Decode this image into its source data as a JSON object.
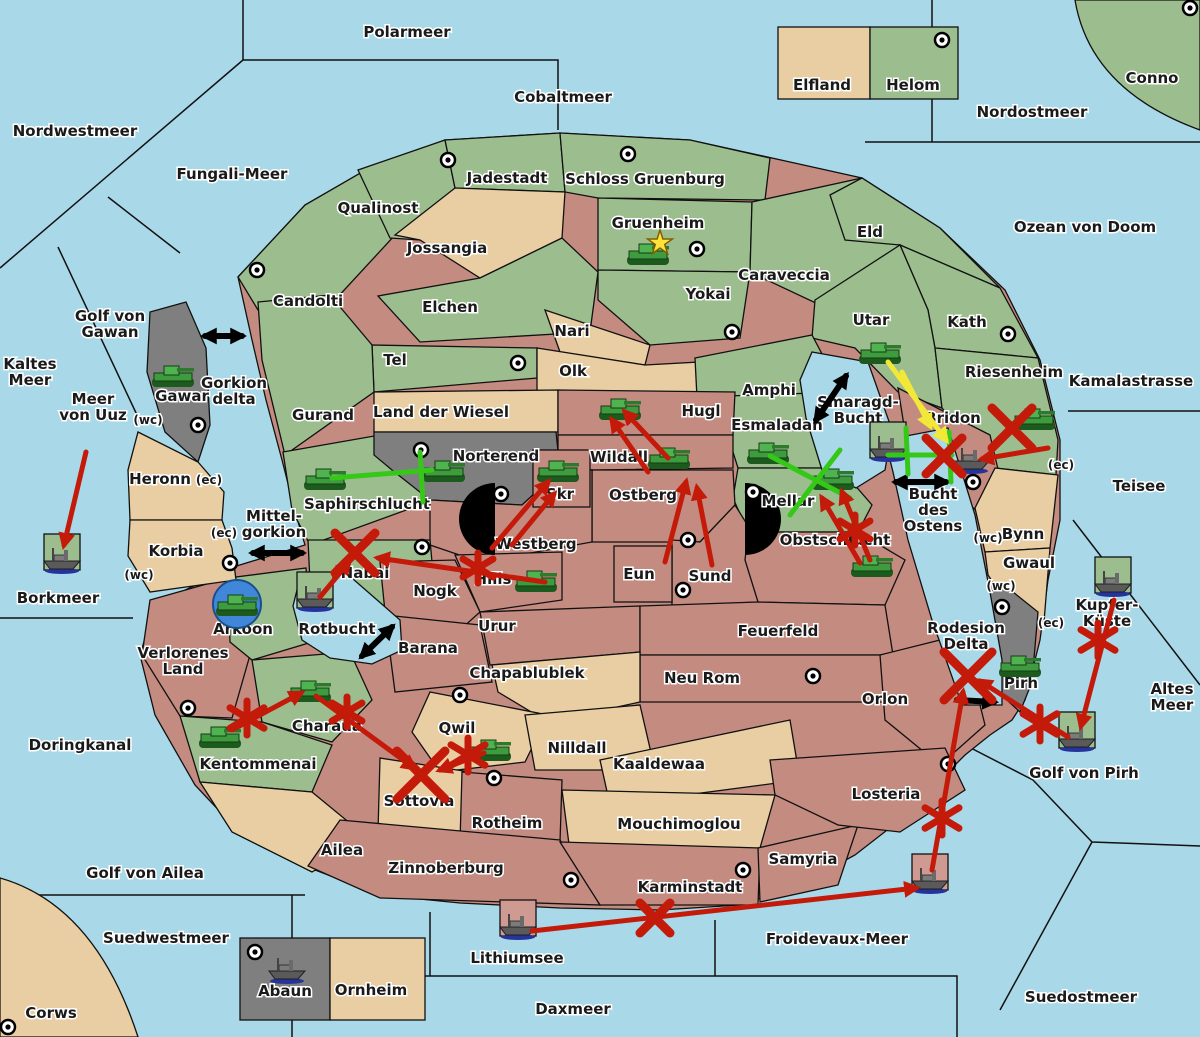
{
  "map": {
    "colors": {
      "sea": "#A9D9E8",
      "land_green": "#9CBE8F",
      "land_tan": "#E8CEA2",
      "land_red": "#C48B81",
      "land_gray": "#7F7F7F",
      "order_red": "#C41A0A",
      "order_green": "#35C818",
      "order_yellow": "#F2E838",
      "order_black": "#000000"
    },
    "labels": [
      {
        "text": "Nordwestmeer",
        "x": 75,
        "y": 131,
        "kind": "sea"
      },
      {
        "text": "Polarmeer",
        "x": 407,
        "y": 32,
        "kind": "sea"
      },
      {
        "text": "Cobaltmeer",
        "x": 563,
        "y": 97,
        "kind": "sea"
      },
      {
        "text": "Nordostmeer",
        "x": 1032,
        "y": 112,
        "kind": "sea"
      },
      {
        "text": "Ozean von Doom",
        "x": 1085,
        "y": 227,
        "kind": "sea"
      },
      {
        "text": "Fungali-Meer",
        "x": 232,
        "y": 174,
        "kind": "sea"
      },
      {
        "text": "Kaltes\nMeer",
        "x": 30,
        "y": 372,
        "kind": "sea"
      },
      {
        "text": "Golf von\nGawan",
        "x": 110,
        "y": 324,
        "kind": "sea"
      },
      {
        "text": "Meer\nvon Uuz",
        "x": 93,
        "y": 407,
        "kind": "sea"
      },
      {
        "text": "Kamalastrasse",
        "x": 1131,
        "y": 381,
        "kind": "sea"
      },
      {
        "text": "Teisee",
        "x": 1139,
        "y": 486,
        "kind": "sea"
      },
      {
        "text": "Borkmeer",
        "x": 58,
        "y": 598,
        "kind": "sea"
      },
      {
        "text": "Doringkanal",
        "x": 80,
        "y": 745,
        "kind": "sea"
      },
      {
        "text": "Golf von Ailea",
        "x": 145,
        "y": 873,
        "kind": "sea"
      },
      {
        "text": "Suedwestmeer",
        "x": 166,
        "y": 938,
        "kind": "sea"
      },
      {
        "text": "Altes\nMeer",
        "x": 1172,
        "y": 697,
        "kind": "sea"
      },
      {
        "text": "Golf von Pirh",
        "x": 1084,
        "y": 773,
        "kind": "sea"
      },
      {
        "text": "Froidevaux-Meer",
        "x": 837,
        "y": 939,
        "kind": "sea"
      },
      {
        "text": "Daxmeer",
        "x": 573,
        "y": 1009,
        "kind": "sea"
      },
      {
        "text": "Suedostmeer",
        "x": 1081,
        "y": 997,
        "kind": "sea"
      },
      {
        "text": "Kupfer-\nKüste",
        "x": 1107,
        "y": 613,
        "kind": "sea"
      },
      {
        "text": "Smaragd-\nBucht",
        "x": 858,
        "y": 410,
        "kind": "sea"
      },
      {
        "text": "Bucht\ndes\nOstens",
        "x": 933,
        "y": 510,
        "kind": "sea"
      },
      {
        "text": "Rodesion\nDelta",
        "x": 966,
        "y": 636,
        "kind": "sea"
      },
      {
        "text": "Mittel-\ngorkion",
        "x": 274,
        "y": 524,
        "kind": "sea"
      },
      {
        "text": "Gorkion\ndelta",
        "x": 234,
        "y": 391,
        "kind": "sea"
      },
      {
        "text": "Rotbucht",
        "x": 337,
        "y": 629,
        "kind": "sea"
      },
      {
        "text": "Lithiumsee",
        "x": 517,
        "y": 958,
        "kind": "sea"
      },
      {
        "text": "Qualinost",
        "x": 378,
        "y": 208,
        "kind": "land"
      },
      {
        "text": "Jadestadt",
        "x": 507,
        "y": 178,
        "kind": "land"
      },
      {
        "text": "Schloss Gruenburg",
        "x": 645,
        "y": 179,
        "kind": "land"
      },
      {
        "text": "Gruenheim",
        "x": 658,
        "y": 223,
        "kind": "land"
      },
      {
        "text": "Caraveccia",
        "x": 784,
        "y": 275,
        "kind": "land"
      },
      {
        "text": "Yokai",
        "x": 708,
        "y": 294,
        "kind": "land"
      },
      {
        "text": "Eld",
        "x": 870,
        "y": 232,
        "kind": "land"
      },
      {
        "text": "Utar",
        "x": 871,
        "y": 320,
        "kind": "land"
      },
      {
        "text": "Kath",
        "x": 967,
        "y": 322,
        "kind": "land"
      },
      {
        "text": "Riesenheim",
        "x": 1014,
        "y": 372,
        "kind": "land"
      },
      {
        "text": "Bridon",
        "x": 953,
        "y": 418,
        "kind": "land"
      },
      {
        "text": "Candolti",
        "x": 308,
        "y": 301,
        "kind": "land"
      },
      {
        "text": "Elchen",
        "x": 450,
        "y": 307,
        "kind": "land"
      },
      {
        "text": "Nari",
        "x": 572,
        "y": 331,
        "kind": "land"
      },
      {
        "text": "Tel",
        "x": 395,
        "y": 360,
        "kind": "land"
      },
      {
        "text": "Olk",
        "x": 573,
        "y": 371,
        "kind": "land"
      },
      {
        "text": "Gurand",
        "x": 323,
        "y": 415,
        "kind": "land"
      },
      {
        "text": "Jossangia",
        "x": 447,
        "y": 248,
        "kind": "land"
      },
      {
        "text": "Land der Wiesel",
        "x": 441,
        "y": 412,
        "kind": "land"
      },
      {
        "text": "Amphi",
        "x": 769,
        "y": 390,
        "kind": "land"
      },
      {
        "text": "Esmaladan",
        "x": 777,
        "y": 425,
        "kind": "land"
      },
      {
        "text": "Mellar",
        "x": 788,
        "y": 501,
        "kind": "land"
      },
      {
        "text": "Norterend",
        "x": 496,
        "y": 456,
        "kind": "land"
      },
      {
        "text": "Wildall",
        "x": 619,
        "y": 457,
        "kind": "land"
      },
      {
        "text": "Skr",
        "x": 560,
        "y": 494,
        "kind": "land"
      },
      {
        "text": "Ostberg",
        "x": 643,
        "y": 495,
        "kind": "land"
      },
      {
        "text": "Westberg",
        "x": 536,
        "y": 544,
        "kind": "land"
      },
      {
        "text": "Hugl",
        "x": 701,
        "y": 411,
        "kind": "land"
      },
      {
        "text": "Saphirschlucht",
        "x": 367,
        "y": 504,
        "kind": "land"
      },
      {
        "text": "Eun",
        "x": 639,
        "y": 574,
        "kind": "land"
      },
      {
        "text": "Sund",
        "x": 710,
        "y": 576,
        "kind": "land"
      },
      {
        "text": "Obstschlucht",
        "x": 835,
        "y": 540,
        "kind": "land"
      },
      {
        "text": "Hills",
        "x": 493,
        "y": 579,
        "kind": "land"
      },
      {
        "text": "Nabai",
        "x": 365,
        "y": 573,
        "kind": "land"
      },
      {
        "text": "Nogk",
        "x": 435,
        "y": 591,
        "kind": "land"
      },
      {
        "text": "Urur",
        "x": 497,
        "y": 626,
        "kind": "land"
      },
      {
        "text": "Barana",
        "x": 428,
        "y": 648,
        "kind": "land"
      },
      {
        "text": "Chapablublek",
        "x": 527,
        "y": 673,
        "kind": "land"
      },
      {
        "text": "Feuerfeld",
        "x": 778,
        "y": 631,
        "kind": "land"
      },
      {
        "text": "Neu Rom",
        "x": 702,
        "y": 678,
        "kind": "land"
      },
      {
        "text": "Orlon",
        "x": 885,
        "y": 699,
        "kind": "land"
      },
      {
        "text": "Qwil",
        "x": 457,
        "y": 728,
        "kind": "land"
      },
      {
        "text": "Nilldall",
        "x": 577,
        "y": 748,
        "kind": "land"
      },
      {
        "text": "Kaaldewaa",
        "x": 659,
        "y": 764,
        "kind": "land"
      },
      {
        "text": "Sottovia",
        "x": 419,
        "y": 801,
        "kind": "land"
      },
      {
        "text": "Rotheim",
        "x": 507,
        "y": 823,
        "kind": "land"
      },
      {
        "text": "Mouchimoglou",
        "x": 679,
        "y": 824,
        "kind": "land"
      },
      {
        "text": "Verlorenes\nLand",
        "x": 183,
        "y": 661,
        "kind": "land"
      },
      {
        "text": "Arkoon",
        "x": 243,
        "y": 629,
        "kind": "land"
      },
      {
        "text": "Charaua",
        "x": 327,
        "y": 726,
        "kind": "land"
      },
      {
        "text": "Kentommenai",
        "x": 258,
        "y": 764,
        "kind": "land"
      },
      {
        "text": "Ailea",
        "x": 342,
        "y": 850,
        "kind": "land"
      },
      {
        "text": "Zinnoberburg",
        "x": 446,
        "y": 868,
        "kind": "land"
      },
      {
        "text": "Karminstadt",
        "x": 690,
        "y": 887,
        "kind": "land"
      },
      {
        "text": "Samyria",
        "x": 803,
        "y": 859,
        "kind": "land"
      },
      {
        "text": "Losteria",
        "x": 886,
        "y": 794,
        "kind": "land"
      },
      {
        "text": "Heronn",
        "x": 160,
        "y": 479,
        "kind": "land"
      },
      {
        "text": "Korbia",
        "x": 176,
        "y": 551,
        "kind": "land"
      },
      {
        "text": "Gawar",
        "x": 182,
        "y": 396,
        "kind": "land"
      },
      {
        "text": "Pirh",
        "x": 1021,
        "y": 683,
        "kind": "land"
      },
      {
        "text": "Bynn",
        "x": 1023,
        "y": 534,
        "kind": "land"
      },
      {
        "text": "Gwaul",
        "x": 1029,
        "y": 563,
        "kind": "land"
      },
      {
        "text": "Abaun",
        "x": 285,
        "y": 991,
        "kind": "land"
      },
      {
        "text": "Ornheim",
        "x": 371,
        "y": 990,
        "kind": "land"
      },
      {
        "text": "Corws",
        "x": 51,
        "y": 1013,
        "kind": "land"
      },
      {
        "text": "Elfland",
        "x": 822,
        "y": 85,
        "kind": "land"
      },
      {
        "text": "Helom",
        "x": 913,
        "y": 85,
        "kind": "land"
      },
      {
        "text": "Conno",
        "x": 1152,
        "y": 78,
        "kind": "land"
      },
      {
        "text": "(wc)",
        "x": 148,
        "y": 419,
        "kind": "tag"
      },
      {
        "text": "(ec)",
        "x": 209,
        "y": 479,
        "kind": "tag"
      },
      {
        "text": "(ec)",
        "x": 224,
        "y": 532,
        "kind": "tag"
      },
      {
        "text": "(wc)",
        "x": 139,
        "y": 574,
        "kind": "tag"
      },
      {
        "text": "(ec)",
        "x": 1061,
        "y": 464,
        "kind": "tag"
      },
      {
        "text": "(wc)",
        "x": 988,
        "y": 537,
        "kind": "tag"
      },
      {
        "text": "(wc)",
        "x": 1001,
        "y": 585,
        "kind": "tag"
      },
      {
        "text": "(ec)",
        "x": 1051,
        "y": 622,
        "kind": "tag"
      }
    ],
    "supply_centers": [
      [
        448,
        160
      ],
      [
        628,
        154
      ],
      [
        697,
        249
      ],
      [
        942,
        40
      ],
      [
        1190,
        8
      ],
      [
        257,
        270
      ],
      [
        518,
        363
      ],
      [
        732,
        332
      ],
      [
        1008,
        334
      ],
      [
        198,
        425
      ],
      [
        421,
        450
      ],
      [
        753,
        492
      ],
      [
        501,
        494
      ],
      [
        688,
        540
      ],
      [
        683,
        590
      ],
      [
        973,
        482
      ],
      [
        230,
        563
      ],
      [
        422,
        547
      ],
      [
        460,
        695
      ],
      [
        494,
        778
      ],
      [
        571,
        880
      ],
      [
        743,
        870
      ],
      [
        948,
        764
      ],
      [
        813,
        676
      ],
      [
        1002,
        607
      ],
      [
        255,
        952
      ],
      [
        8,
        1027
      ],
      [
        188,
        708
      ]
    ],
    "capital_star": {
      "x": 660,
      "y": 243
    },
    "arkoon_circle": {
      "x": 237,
      "y": 604,
      "r": 24
    },
    "units": {
      "tanks": [
        {
          "x": 648,
          "y": 253,
          "territory": "Gruenheim"
        },
        {
          "x": 173,
          "y": 375,
          "territory": "Gawar"
        },
        {
          "x": 880,
          "y": 352,
          "territory": "Utar"
        },
        {
          "x": 325,
          "y": 478,
          "territory": "Saphirschlucht"
        },
        {
          "x": 444,
          "y": 470,
          "territory": "Norterend"
        },
        {
          "x": 558,
          "y": 470,
          "territory": "Skr"
        },
        {
          "x": 620,
          "y": 408,
          "territory": "Hugl"
        },
        {
          "x": 669,
          "y": 457,
          "territory": "Wildall"
        },
        {
          "x": 768,
          "y": 452,
          "territory": "Esmaladan"
        },
        {
          "x": 833,
          "y": 478,
          "territory": "Mellar"
        },
        {
          "x": 1034,
          "y": 418,
          "territory": "Riesenheim"
        },
        {
          "x": 536,
          "y": 580,
          "territory": "Hills"
        },
        {
          "x": 237,
          "y": 604,
          "territory": "Arkoon"
        },
        {
          "x": 310,
          "y": 690,
          "territory": "Charaua"
        },
        {
          "x": 220,
          "y": 736,
          "territory": "Kentommenai"
        },
        {
          "x": 490,
          "y": 749,
          "territory": "Qwil"
        },
        {
          "x": 872,
          "y": 565,
          "territory": "Obstschlucht"
        },
        {
          "x": 1020,
          "y": 665,
          "territory": "Pirh"
        }
      ],
      "ships": [
        {
          "x": 62,
          "y": 562,
          "box": "green",
          "territory": "Borkmeer"
        },
        {
          "x": 888,
          "y": 450,
          "box": "green",
          "territory": "Smaragd-Bucht"
        },
        {
          "x": 315,
          "y": 600,
          "box": "green",
          "territory": "Rotbucht"
        },
        {
          "x": 1113,
          "y": 585,
          "box": "green",
          "territory": "Kupfer-Küste"
        },
        {
          "x": 1077,
          "y": 740,
          "box": "green",
          "territory": "Golf von Pirh"
        },
        {
          "x": 518,
          "y": 928,
          "box": "red",
          "territory": "Lithiumsee"
        },
        {
          "x": 930,
          "y": 882,
          "box": "red",
          "territory": "Froidevaux-Meer"
        },
        {
          "x": 971,
          "y": 462,
          "box": "none",
          "territory": "Bridon"
        },
        {
          "x": 287,
          "y": 972,
          "box": "none",
          "territory": "Abaun"
        }
      ]
    },
    "orders": {
      "red_arrows": [
        [
          86,
          452,
          64,
          545
        ],
        [
          545,
          582,
          378,
          558
        ],
        [
          320,
          597,
          349,
          562
        ],
        [
          492,
          548,
          548,
          482
        ],
        [
          512,
          545,
          554,
          494
        ],
        [
          665,
          562,
          686,
          482
        ],
        [
          712,
          565,
          697,
          488
        ],
        [
          668,
          458,
          625,
          412
        ],
        [
          648,
          472,
          612,
          420
        ],
        [
          870,
          560,
          842,
          492
        ],
        [
          860,
          563,
          822,
          498
        ],
        [
          1048,
          448,
          982,
          459
        ],
        [
          232,
          730,
          301,
          693
        ],
        [
          316,
          696,
          414,
          768
        ],
        [
          484,
          753,
          440,
          770
        ],
        [
          1114,
          600,
          1081,
          726
        ],
        [
          1068,
          737,
          980,
          681
        ],
        [
          932,
          870,
          963,
          692
        ],
        [
          532,
          931,
          916,
          888
        ]
      ],
      "yellow_arrows": [
        [
          888,
          362,
          946,
          440
        ],
        [
          902,
          372,
          930,
          426
        ]
      ],
      "green_lines": [
        [
          332,
          478,
          432,
          470
        ],
        [
          770,
          456,
          850,
          498
        ],
        [
          790,
          515,
          840,
          450
        ],
        [
          888,
          455,
          952,
          455
        ]
      ],
      "green_bars": [
        [
          420,
          452,
          423,
          502
        ],
        [
          906,
          428,
          908,
          474
        ],
        [
          949,
          432,
          951,
          482
        ]
      ],
      "black_double_arrows": [
        [
          205,
          336,
          242,
          336
        ],
        [
          816,
          420,
          846,
          376
        ],
        [
          896,
          482,
          946,
          482
        ],
        [
          253,
          553,
          302,
          553
        ],
        [
          362,
          656,
          392,
          627
        ]
      ],
      "black_arrows": [
        [
          957,
          700,
          994,
          702
        ]
      ],
      "fail_x": [
        [
          355,
          553,
          20
        ],
        [
          421,
          775,
          24
        ],
        [
          968,
          676,
          24
        ],
        [
          1012,
          428,
          20
        ],
        [
          944,
          456,
          18
        ],
        [
          655,
          918,
          15
        ]
      ],
      "cut_stars": [
        [
          247,
          718,
          17
        ],
        [
          468,
          755,
          17
        ],
        [
          347,
          712,
          15
        ],
        [
          478,
          568,
          15
        ],
        [
          855,
          530,
          15
        ],
        [
          1098,
          640,
          17
        ],
        [
          1040,
          724,
          17
        ],
        [
          942,
          818,
          17
        ]
      ]
    }
  }
}
